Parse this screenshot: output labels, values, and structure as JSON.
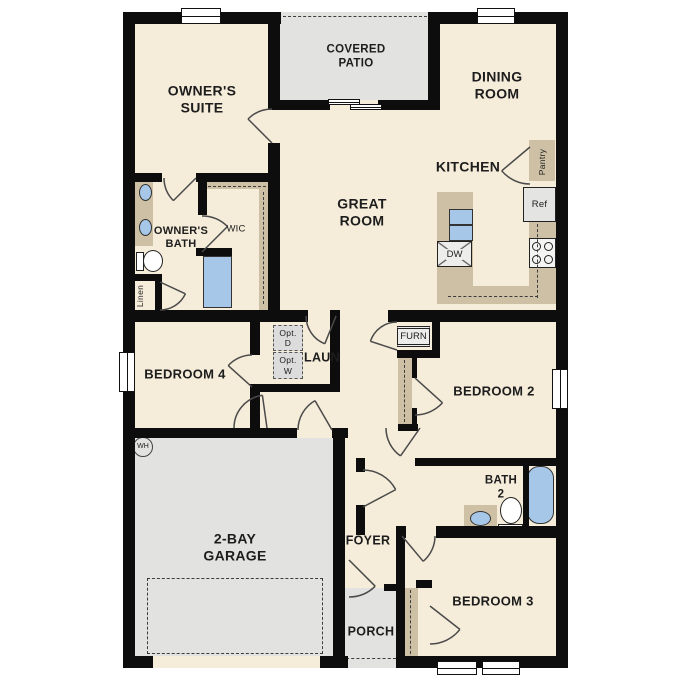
{
  "plan": {
    "rooms": {
      "owners_suite": "OWNER'S\nSUITE",
      "covered_patio": "COVERED\nPATIO",
      "dining_room": "DINING\nROOM",
      "kitchen": "KITCHEN",
      "great_room": "GREAT\nROOM",
      "owners_bath": "OWNER'S\nBATH",
      "wic": "WIC",
      "laundry": "LAUN",
      "bedroom_4": "BEDROOM 4",
      "bedroom_2": "BEDROOM 2",
      "bath_2": "BATH\n2",
      "garage": "2-BAY\nGARAGE",
      "foyer": "FOYER",
      "porch": "PORCH",
      "bedroom_3": "BEDROOM 3"
    },
    "closets": {
      "pantry": "Pantry",
      "linen": "Linen"
    },
    "equipment": {
      "ref": "Ref",
      "dw": "DW",
      "furn": "FURN",
      "wh": "WH",
      "opt_dryer": "Opt.\nD",
      "opt_washer": "Opt.\nW"
    },
    "colors": {
      "floor": "#f5ecda",
      "outdoor": "#e2e2e1",
      "cabinetry": "#cec0a4",
      "plumbing_fixture": "#a7c7e8",
      "wall": "#0d0d0d"
    }
  }
}
